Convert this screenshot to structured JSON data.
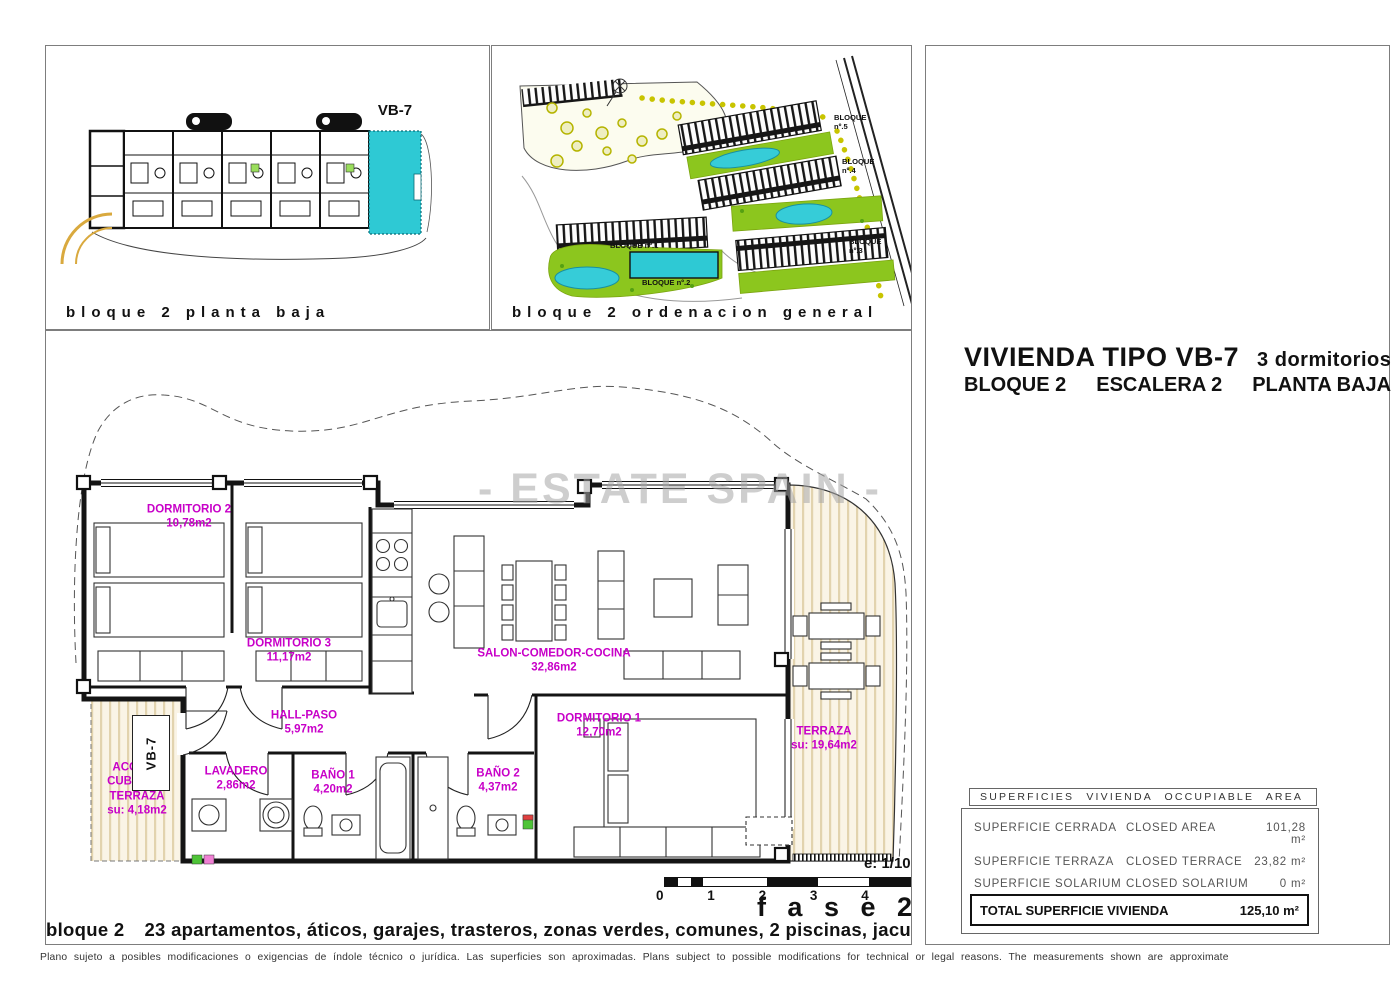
{
  "page": {
    "watermark": "- ESTATE SPAIN -",
    "disclaimer": "Plano sujeto a posibles modificaciones o exigencias de índole técnico o jurídica. Las superficies son aproximadas. Plans subject to possible modifications for technical or legal reasons. The measurements shown are approximate"
  },
  "block_plan_panel": {
    "caption": "bloque 2 planta baja",
    "highlight_label": "VB-7"
  },
  "site_plan_panel": {
    "caption": "bloque 2 ordenacion general",
    "bloques": [
      "BLOQUE nº.1",
      "BLOQUE nº.2",
      "BLOQUE nº.3",
      "BLOQUE nº.4",
      "BLOQUE nº.5"
    ]
  },
  "title_block": {
    "type_title": "VIVIENDA TIPO VB-7",
    "bedrooms": "3 dormitorios",
    "bloque": "BLOQUE 2",
    "escalera": "ESCALERA 2",
    "planta": "PLANTA BAJA"
  },
  "floor_plan": {
    "rooms": [
      {
        "name": "DORMITORIO 2",
        "area": "10,78m2"
      },
      {
        "name": "DORMITORIO 3",
        "area": "11,17m2"
      },
      {
        "name": "SALON-COMEDOR-COCINA",
        "area": "32,86m2"
      },
      {
        "name": "HALL-PASO",
        "area": "5,97m2"
      },
      {
        "name": "DORMITORIO 1",
        "area": "12,70m2"
      },
      {
        "name": "LAVADERO",
        "area": "2,86m2"
      },
      {
        "name": "BAÑO 1",
        "area": "4,20m2"
      },
      {
        "name": "BAÑO 2",
        "area": "4,37m2"
      },
      {
        "name": "TERRAZA",
        "area": "su: 19,64m2"
      },
      {
        "name": "ACCESO CUBIERTO TERRAZA",
        "area": "su: 4,18m2"
      }
    ],
    "entrance_label": "VB-7",
    "scale_label": "e: 1/100",
    "scale_ticks": [
      "0",
      "1",
      "2",
      "3",
      "4",
      "5m"
    ],
    "phase_label": "f a s e 2",
    "caption_prefix": "bloque 2",
    "caption_rest": "23 apartamentos, áticos, garajes, trasteros, zonas verdes, comunes, 2 piscinas, jacuzzi"
  },
  "surfaces_table": {
    "header": "SUPERFICIES VIVIENDA OCCUPIABLE AREA",
    "rows": [
      {
        "es": "SUPERFICIE CERRADA",
        "en": "CLOSED AREA",
        "value": "101,28 m²"
      },
      {
        "es": "SUPERFICIE TERRAZA",
        "en": "CLOSED TERRACE",
        "value": "23,82 m²"
      },
      {
        "es": "SUPERFICIE SOLARIUM",
        "en": "CLOSED SOLARIUM",
        "value": "0 m²"
      }
    ],
    "total_label": "TOTAL SUPERFICIE VIVIENDA",
    "total_value": "125,10 m²"
  },
  "colors": {
    "highlight_cyan": "#2ec9d4",
    "label_magenta": "#c800c8",
    "deck_stripe": "#e2d3ae",
    "site_green": "#8cc61e",
    "pool_cyan": "#36ccd8"
  }
}
